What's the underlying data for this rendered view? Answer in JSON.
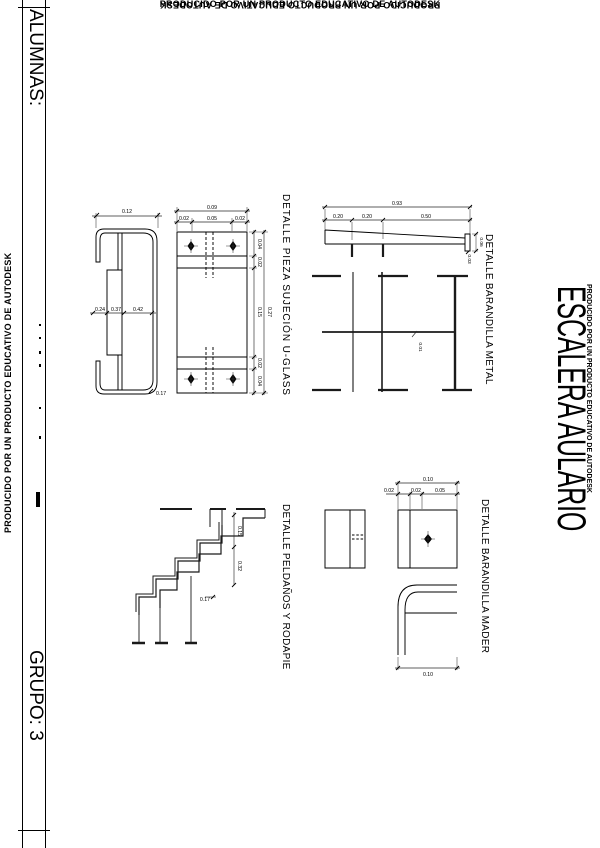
{
  "page": {
    "producido_top": "PRODUCIDO POR UN PRODUCTO EDUCATIVO DE AUTODESK",
    "producido_bottom": "PRODUCIDO POR UN PRODUCTO EDUCATIVO DE AUTODESK",
    "producido_left": "PRODUCIDO POR UN PRODUCTO EDUCATIVO DE AUTODESK",
    "producido_right": "PRODUCIDO POR UN PRODUCTO EDUCATIVO DE AUTODESK"
  },
  "title_block": {
    "alumnas_label": "ALUMNAS:",
    "grupo_label": "GRUPO: 3"
  },
  "sheet": {
    "title": "ESCALERA AULARIO"
  },
  "details": {
    "uglass": {
      "title": "DETALLE PIEZA SUJECIÓN U-GLASS",
      "dims": {
        "profile_width": "0.12",
        "seg1": "0.24",
        "seg2": "0.37",
        "seg3": "0.42",
        "thickness": "0.17",
        "plate_w_total": "0.09",
        "plate_w1": "0.02",
        "plate_w2": "0.05",
        "plate_w3": "0.02",
        "plate_h_total": "0.27",
        "plate_h1": "0.04",
        "plate_h2": "0.02",
        "plate_h3": "0.15",
        "plate_h4": "0.02",
        "plate_h5": "0.04"
      }
    },
    "metal": {
      "title": "DETALLE BARANDILLA METAL",
      "dims": {
        "total": "0.93",
        "seg1": "0.20",
        "seg2": "0.20",
        "seg3": "0.50",
        "end_height": "0.06",
        "end_offset": "0.03",
        "rail_thickness": "0.01"
      }
    },
    "madera": {
      "title": "DETALLE BARANDILLA MADER",
      "dims": {
        "top_total": "0.10",
        "w1": "0.02",
        "w2": "0.02",
        "w3": "0.05",
        "bottom_total": "0.10"
      }
    },
    "stairs": {
      "title": "DETALLE PELDAÑOS Y RODAPIE",
      "dims": {
        "riser": "0.15",
        "tread": "0.32",
        "step_depth": "0.17"
      }
    }
  }
}
